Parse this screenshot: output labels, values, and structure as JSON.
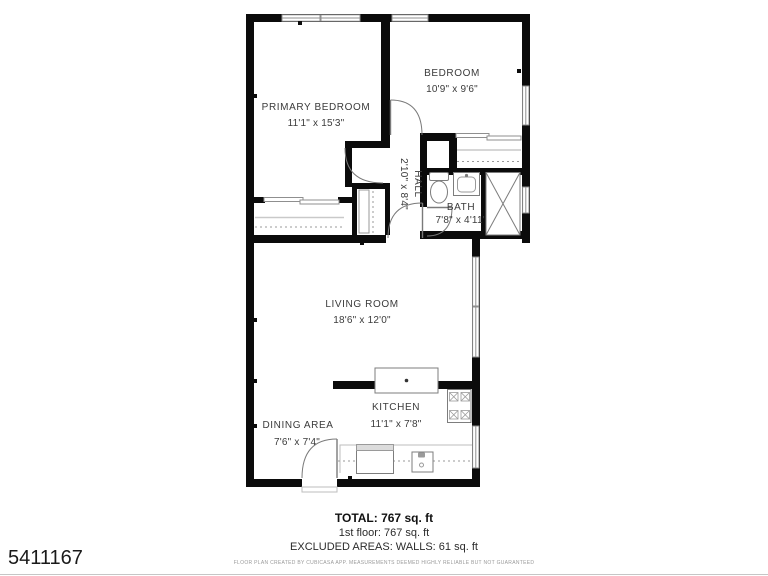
{
  "colors": {
    "wall": "#0b0b0b",
    "label_text": "#3b3b3b",
    "fixture_stroke": "#8f8f8f"
  },
  "photo_id": "5411167",
  "plan": {
    "rooms": [
      {
        "label": "PRIMARY BEDROOM",
        "dims": "11'1\" x 15'3\""
      },
      {
        "label": "BEDROOM",
        "dims": "10'9\" x 9'6\""
      },
      {
        "label": "HALL",
        "dims": "2'10\" x 8'4\""
      },
      {
        "label": "BATH",
        "dims": "7'8\" x 4'11\""
      },
      {
        "label": "LIVING ROOM",
        "dims": "18'6\" x 12'0\""
      },
      {
        "label": "KITCHEN",
        "dims": "11'1\" x 7'8\""
      },
      {
        "label": "DINING AREA",
        "dims": "7'6\" x 7'4\""
      }
    ],
    "summary": {
      "total": "TOTAL: 767 sq. ft",
      "floor": "1st floor: 767 sq. ft",
      "excluded": "EXCLUDED AREAS: WALLS: 61 sq. ft"
    },
    "disclaimer": "FLOOR PLAN CREATED BY CUBICASA APP. MEASUREMENTS DEEMED HIGHLY RELIABLE BUT NOT GUARANTEED"
  }
}
